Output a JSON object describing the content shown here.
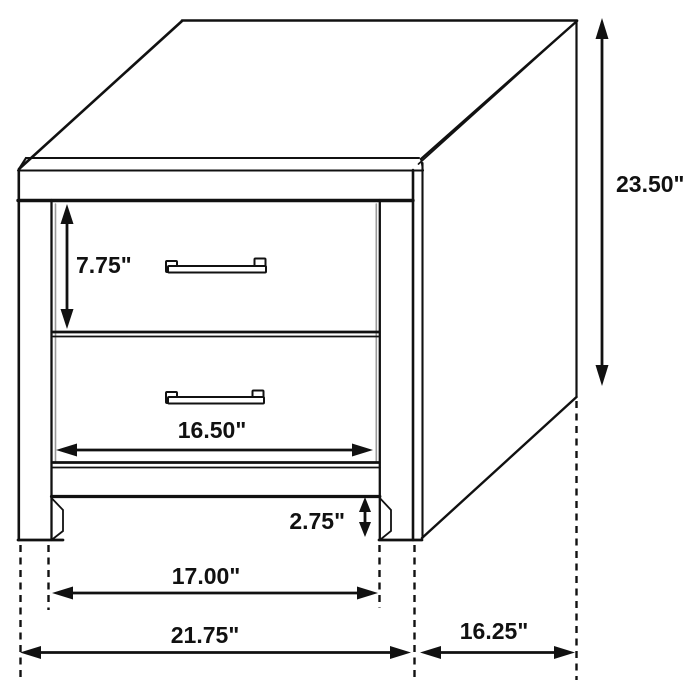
{
  "figure": {
    "type": "furniture-dimension-diagram",
    "units": "inches",
    "views": "isometric line drawing of a two-drawer nightstand with dimension arrows"
  },
  "dimensions": {
    "drawer_height": "7.75\"",
    "overall_height": "23.50\"",
    "drawer_width": "16.50\"",
    "floor_clearance": "2.75\"",
    "leg_inner_span": "17.00\"",
    "overall_width": "21.75\"",
    "overall_depth": "16.25\""
  },
  "colors": {
    "line": "#111111",
    "background": "#ffffff",
    "shade": "#9b9b9b"
  }
}
